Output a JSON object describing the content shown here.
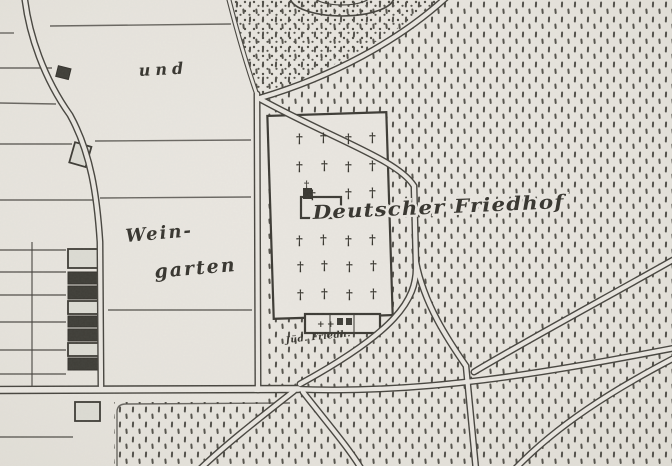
{
  "figure": {
    "kind": "historical-map-scan"
  },
  "map": {
    "labels": {
      "und": "und",
      "weingarten_line1": "Wein-",
      "weingarten_line2": "garten",
      "deutscher_friedhof": "Deutscher Friedhof",
      "juedischer_friedhof": "Jüd. Friedh."
    },
    "symbols": {
      "grave_cross": "†",
      "annex_cross": "+"
    },
    "colors": {
      "paper": "#e9e6e0",
      "ink": "#38362f",
      "stipple": "#52504a"
    },
    "grave_crosses": [
      {
        "x": 296,
        "y": 143
      },
      {
        "x": 320,
        "y": 142
      },
      {
        "x": 345,
        "y": 143
      },
      {
        "x": 369,
        "y": 142
      },
      {
        "x": 296,
        "y": 171
      },
      {
        "x": 321,
        "y": 170
      },
      {
        "x": 345,
        "y": 171
      },
      {
        "x": 369,
        "y": 170
      },
      {
        "x": 309,
        "y": 199
      },
      {
        "x": 345,
        "y": 198
      },
      {
        "x": 369,
        "y": 197
      },
      {
        "x": 296,
        "y": 245
      },
      {
        "x": 320,
        "y": 244
      },
      {
        "x": 345,
        "y": 245
      },
      {
        "x": 369,
        "y": 244
      },
      {
        "x": 297,
        "y": 271
      },
      {
        "x": 321,
        "y": 270
      },
      {
        "x": 346,
        "y": 271
      },
      {
        "x": 370,
        "y": 270
      },
      {
        "x": 297,
        "y": 299
      },
      {
        "x": 321,
        "y": 298
      },
      {
        "x": 346,
        "y": 299
      },
      {
        "x": 370,
        "y": 298
      }
    ],
    "annex_crosses": [
      {
        "x": 317,
        "y": 327
      },
      {
        "x": 327,
        "y": 327
      }
    ]
  }
}
